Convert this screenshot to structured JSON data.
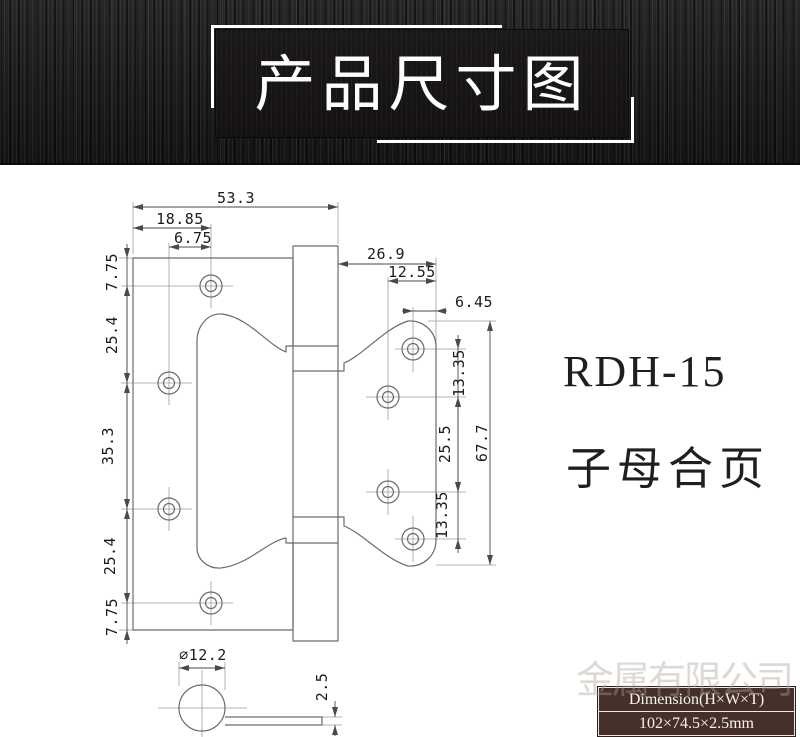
{
  "banner": {
    "title": "产品尺寸图"
  },
  "product": {
    "model": "RDH-15",
    "name": "子母合页"
  },
  "dims": {
    "overall_width": "53.3",
    "hole_col1_offset": "18.85",
    "hole_col_gap": "6.75",
    "small_leaf_width": "26.9",
    "small_hole_col2_offset": "12.55",
    "small_hole_col1_offset": "6.45",
    "left_edge_top": "7.75",
    "left_pitch1": "25.4",
    "left_pitch2": "35.3",
    "left_pitch3": "25.4",
    "left_edge_bottom": "7.75",
    "right_pitch1": "13.35",
    "right_pitch2": "25.5",
    "right_pitch3": "13.35",
    "small_leaf_height": "67.7",
    "knuckle_diameter": "∅12.2",
    "leaf_thickness": "2.5"
  },
  "spec_table": {
    "header": "Dimension(H×W×T)",
    "value": "102×74.5×2.5mm"
  },
  "watermark": {
    "text": "金属有限公司"
  }
}
